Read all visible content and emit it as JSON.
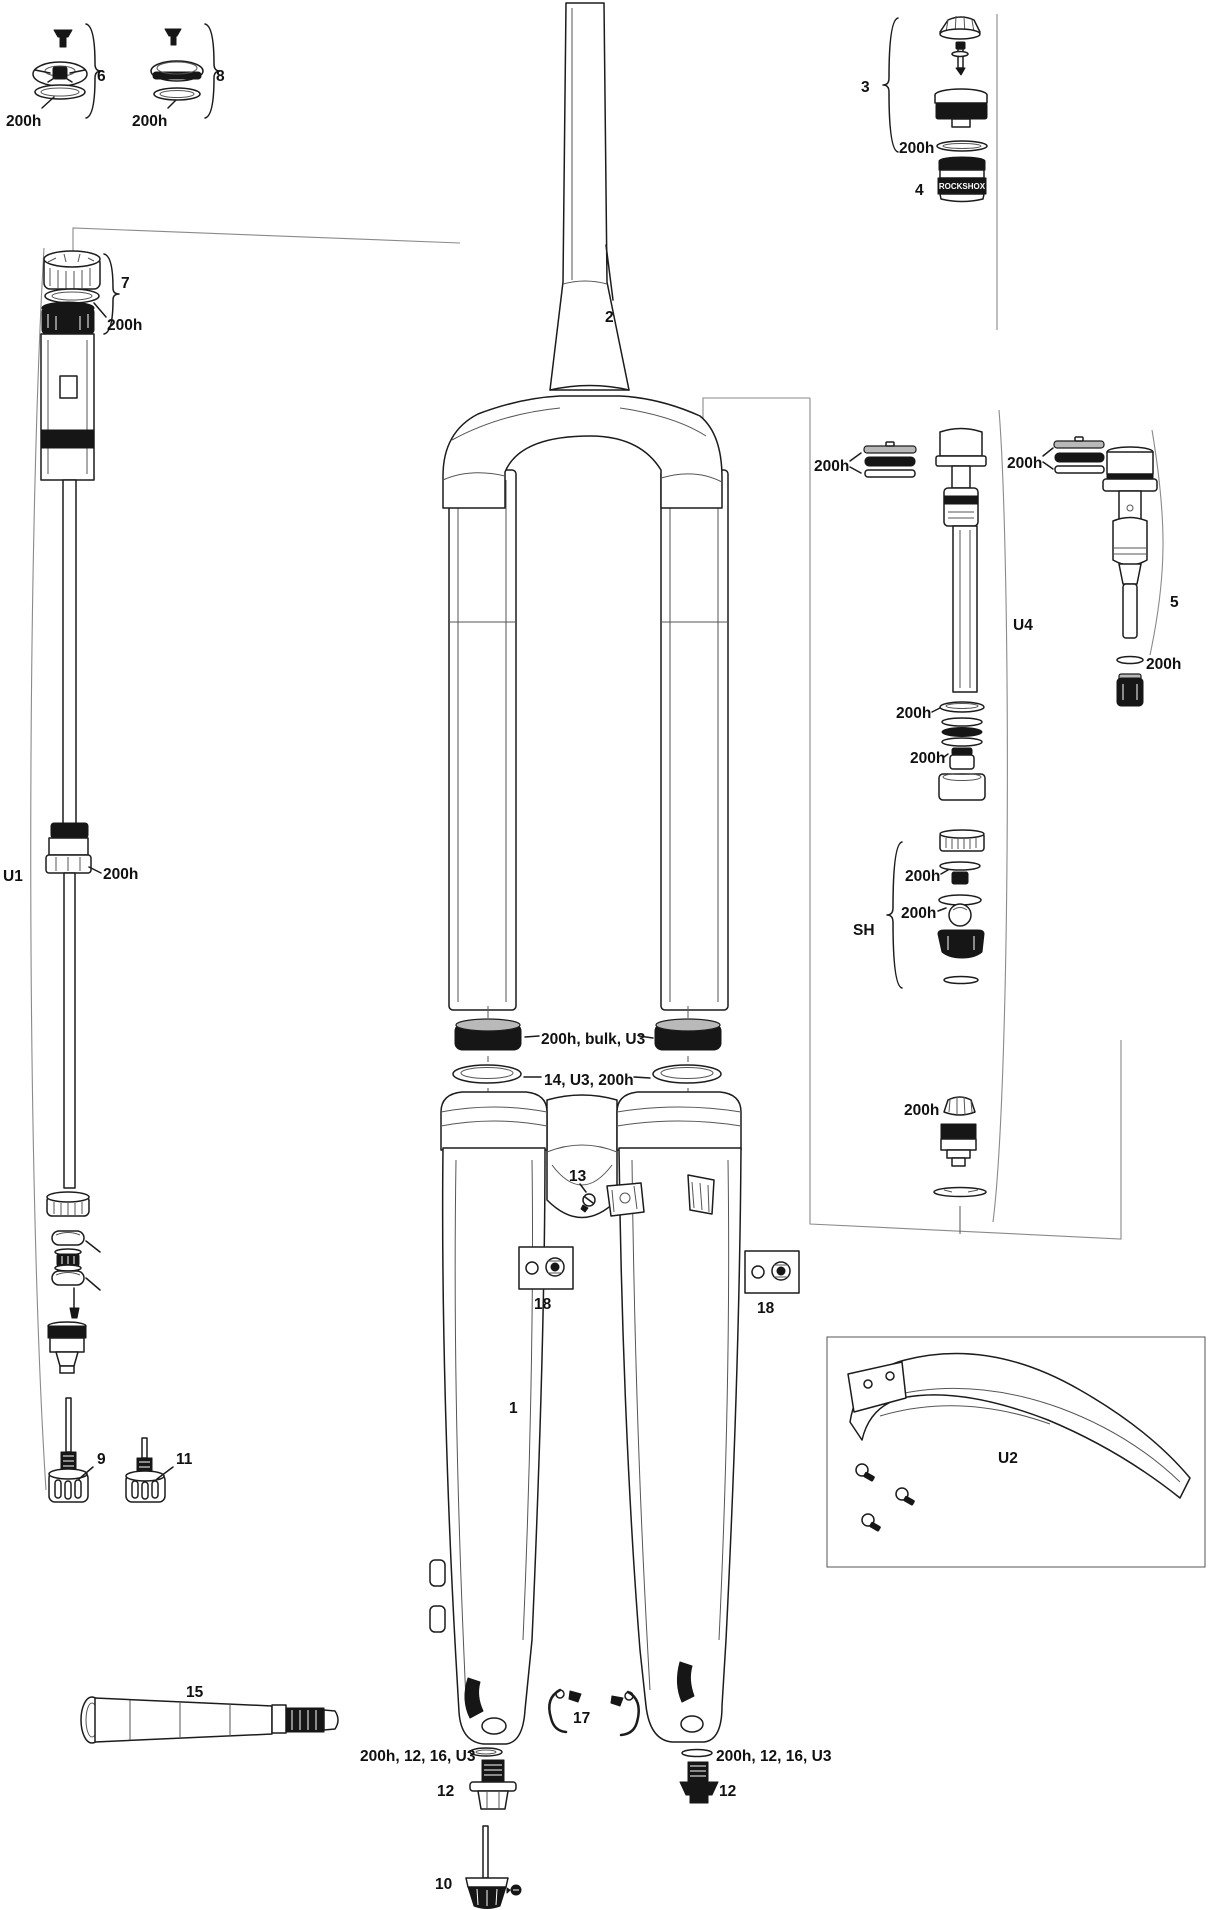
{
  "labels": {
    "part1": "1",
    "part2": "2",
    "part3": "3",
    "part4": "4",
    "part5": "5",
    "part6": "6",
    "part7": "7",
    "part8": "8",
    "part9": "9",
    "part10": "10",
    "part11": "11",
    "part12": "12",
    "part13": "13",
    "part15": "15",
    "part17": "17",
    "part18": "18",
    "groupU1": "U1",
    "groupU2": "U2",
    "groupU4": "U4",
    "groupSH": "SH",
    "wear": "200h",
    "sealKit": "200h, bulk, U3",
    "foamKit": "14, U3, 200h",
    "axleKit": "200h, 12, 16, U3",
    "brand": "ROCKSHOX"
  }
}
